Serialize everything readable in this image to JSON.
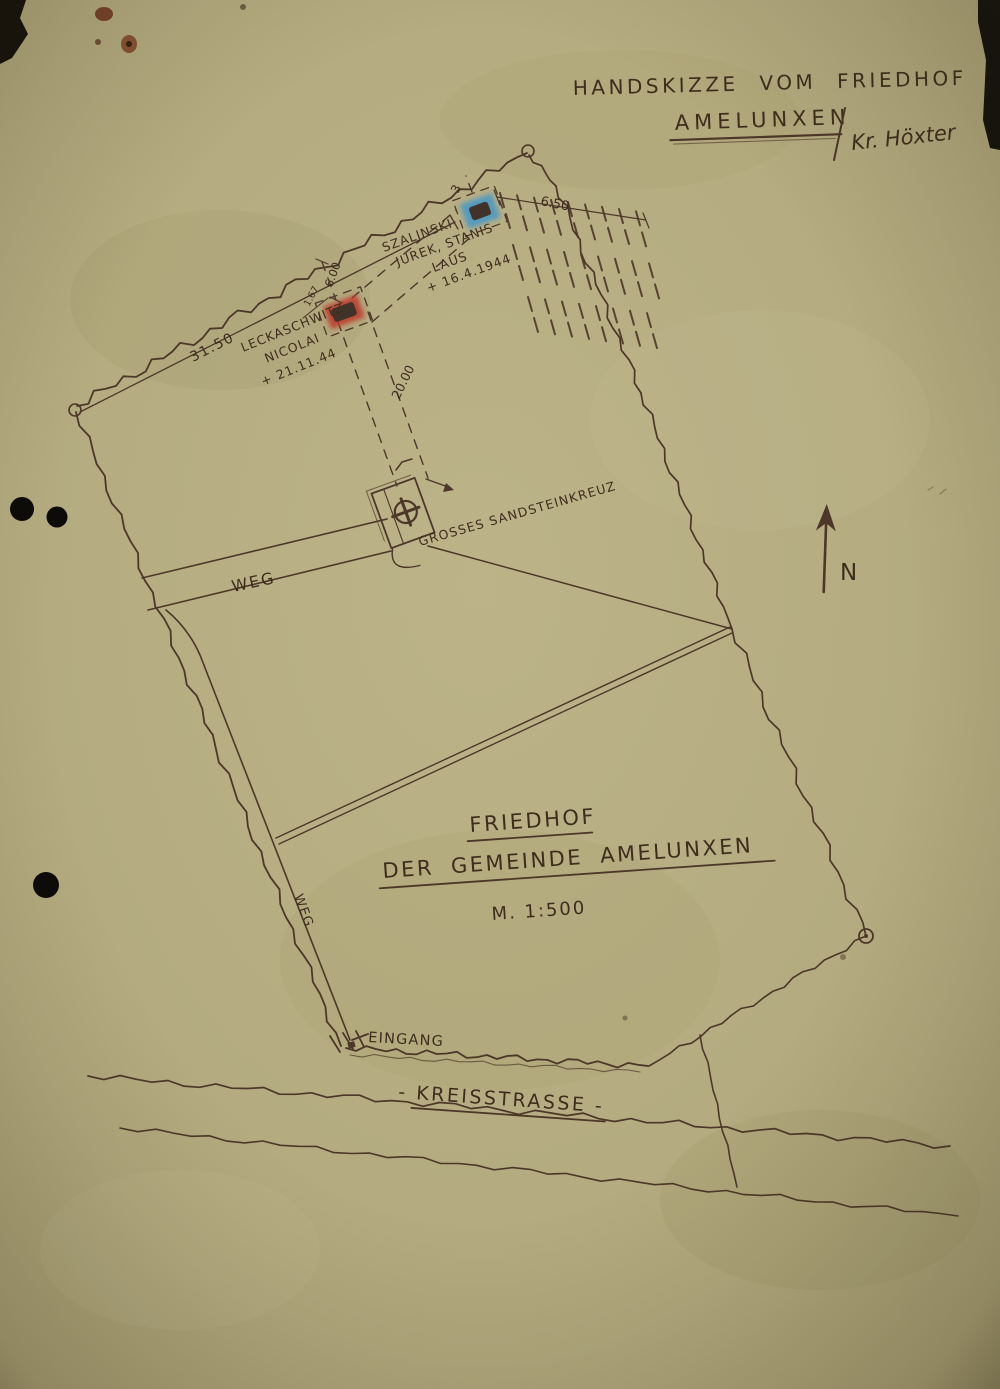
{
  "header": {
    "line1": "HANDSKIZZE VOM FRIEDHOF",
    "place": "AMELUNXEN",
    "district": "Kr. Höxter"
  },
  "cemetery": {
    "name_line1": "FRIEDHOF",
    "name_line2": "DER GEMEINDE AMELUNXEN",
    "scale": "M. 1:500",
    "north": "N",
    "labels": {
      "path_top": "WEG",
      "path_side": "WEG",
      "entrance": "EINGANG",
      "road": "- KREISSTRASSE -",
      "stone_cross": "GROSSES SANDSTEINKREUZ"
    },
    "graves": [
      {
        "marker": "red",
        "color": "#c0392b",
        "lines": [
          "LECKASCHWITZ",
          "NICOLAI",
          "+ 21.11.44"
        ]
      },
      {
        "marker": "blue",
        "color": "#4498c8",
        "lines": [
          "SZALINSKI",
          "JUREK, STANIS",
          "LAUS",
          "+ 16.4.1944"
        ]
      }
    ],
    "dimensions": {
      "boundary_top": "31.50",
      "strip_width": "6.00",
      "grave_width": "1.67",
      "strip_length": "20.00",
      "row_length": "6.50",
      "corner_offset": "3"
    }
  }
}
